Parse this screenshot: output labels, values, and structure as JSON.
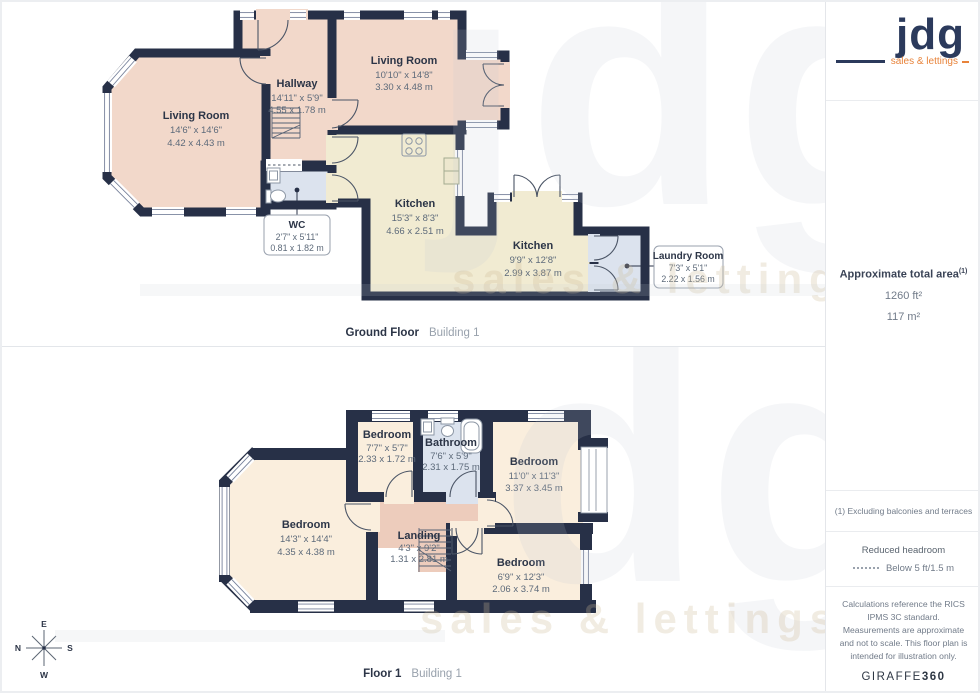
{
  "ground_floor": {
    "title": "Ground Floor",
    "building": "Building 1",
    "rooms": {
      "living_left": {
        "name": "Living Room",
        "imperial": "14'6\" x 14'6\"",
        "metric": "4.42 x 4.43 m"
      },
      "hallway": {
        "name": "Hallway",
        "imperial": "14'11\" x 5'9\"",
        "metric": "4.55 x 1.78 m"
      },
      "living_top": {
        "name": "Living Room",
        "imperial": "10'10\" x 14'8\"",
        "metric": "3.30 x 4.48 m"
      },
      "kitchen_main": {
        "name": "Kitchen",
        "imperial": "15'3\" x 8'3\"",
        "metric": "4.66 x 2.51 m"
      },
      "kitchen_rear": {
        "name": "Kitchen",
        "imperial": "9'9\" x 12'8\"",
        "metric": "2.99 x 3.87 m"
      },
      "wc": {
        "name": "WC",
        "imperial": "2'7\" x 5'11\"",
        "metric": "0.81 x 1.82 m"
      },
      "laundry": {
        "name": "Laundry Room",
        "imperial": "7'3\" x 5'1\"",
        "metric": "2.22 x 1.56 m"
      }
    }
  },
  "floor_1": {
    "title": "Floor 1",
    "building": "Building 1",
    "rooms": {
      "bedroom_large": {
        "name": "Bedroom",
        "imperial": "14'3\" x 14'4\"",
        "metric": "4.35 x 4.38 m"
      },
      "bedroom_small": {
        "name": "Bedroom",
        "imperial": "7'7\" x 5'7\"",
        "metric": "2.33 x 1.72 m"
      },
      "bathroom": {
        "name": "Bathroom",
        "imperial": "7'6\" x 5'9\"",
        "metric": "2.31 x 1.75 m"
      },
      "bedroom_right": {
        "name": "Bedroom",
        "imperial": "11'0\" x 11'3\"",
        "metric": "3.37 x 3.45 m"
      },
      "bedroom_bottom": {
        "name": "Bedroom",
        "imperial": "6'9\" x 12'3\"",
        "metric": "2.06 x 3.74 m"
      },
      "landing": {
        "name": "Landing",
        "imperial": "4'3\" x 9'2\"",
        "metric": "1.31 x 2.81 m"
      }
    }
  },
  "compass": {
    "north": "N",
    "east": "E",
    "south": "S",
    "west": "W"
  },
  "sidebar": {
    "logo": {
      "brand": "jdg",
      "tagline": "sales & lettings"
    },
    "area": {
      "label": "Approximate total area",
      "footnote_ref": "(1)",
      "imperial": "1260 ft²",
      "metric": "117 m²"
    },
    "footnote": "(1) Excluding balconies and terraces",
    "legend": {
      "title": "Reduced headroom",
      "item": "Below 5 ft/1.5 m"
    },
    "disclaimer": "Calculations reference the RICS IPMS 3C standard. Measurements are approximate and not to scale. This floor plan is intended for illustration only.",
    "brand_footer": {
      "name": "GIRAFFE",
      "suffix": "360"
    }
  },
  "watermark": {
    "brand": "jdg",
    "brand_partial": "dg",
    "tagline": "sales & lettings"
  },
  "colors": {
    "wall": "#273047",
    "room_pink": "#f2d8ca",
    "room_cream": "#faeedd",
    "room_beige": "#f1ebd2",
    "room_blue": "#dce3ee",
    "landing_pink": "#edccbc",
    "brand_navy": "#2b3a5c",
    "brand_orange": "#e8833a"
  }
}
